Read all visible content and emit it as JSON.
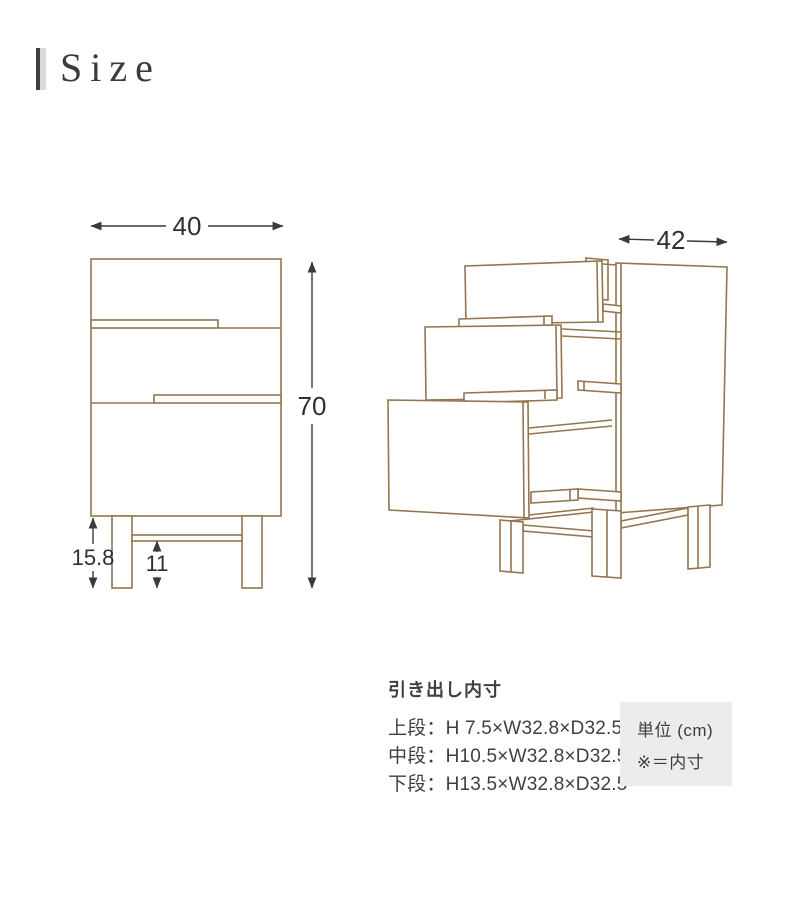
{
  "header": {
    "title": "Size"
  },
  "front_view": {
    "width_label": "40",
    "height_label": "70",
    "leg_height_label": "15.8",
    "leg_clearance_label": "11"
  },
  "perspective_view": {
    "depth_label": "42"
  },
  "specs": {
    "heading": "引き出し内寸",
    "rows": [
      "上段：H 7.5×W32.8×D32.5",
      "中段：H10.5×W32.8×D32.5",
      "下段：H13.5×W32.8×D32.5"
    ]
  },
  "unit_note": {
    "line1": "単位 (cm)",
    "line2": "※＝内寸"
  },
  "colors": {
    "drawing_line": "#93754f",
    "dimension_line": "#3a3a3a",
    "note_background": "#edecea",
    "accent_dark": "#3e3d42",
    "accent_light": "#d9d9d9"
  }
}
